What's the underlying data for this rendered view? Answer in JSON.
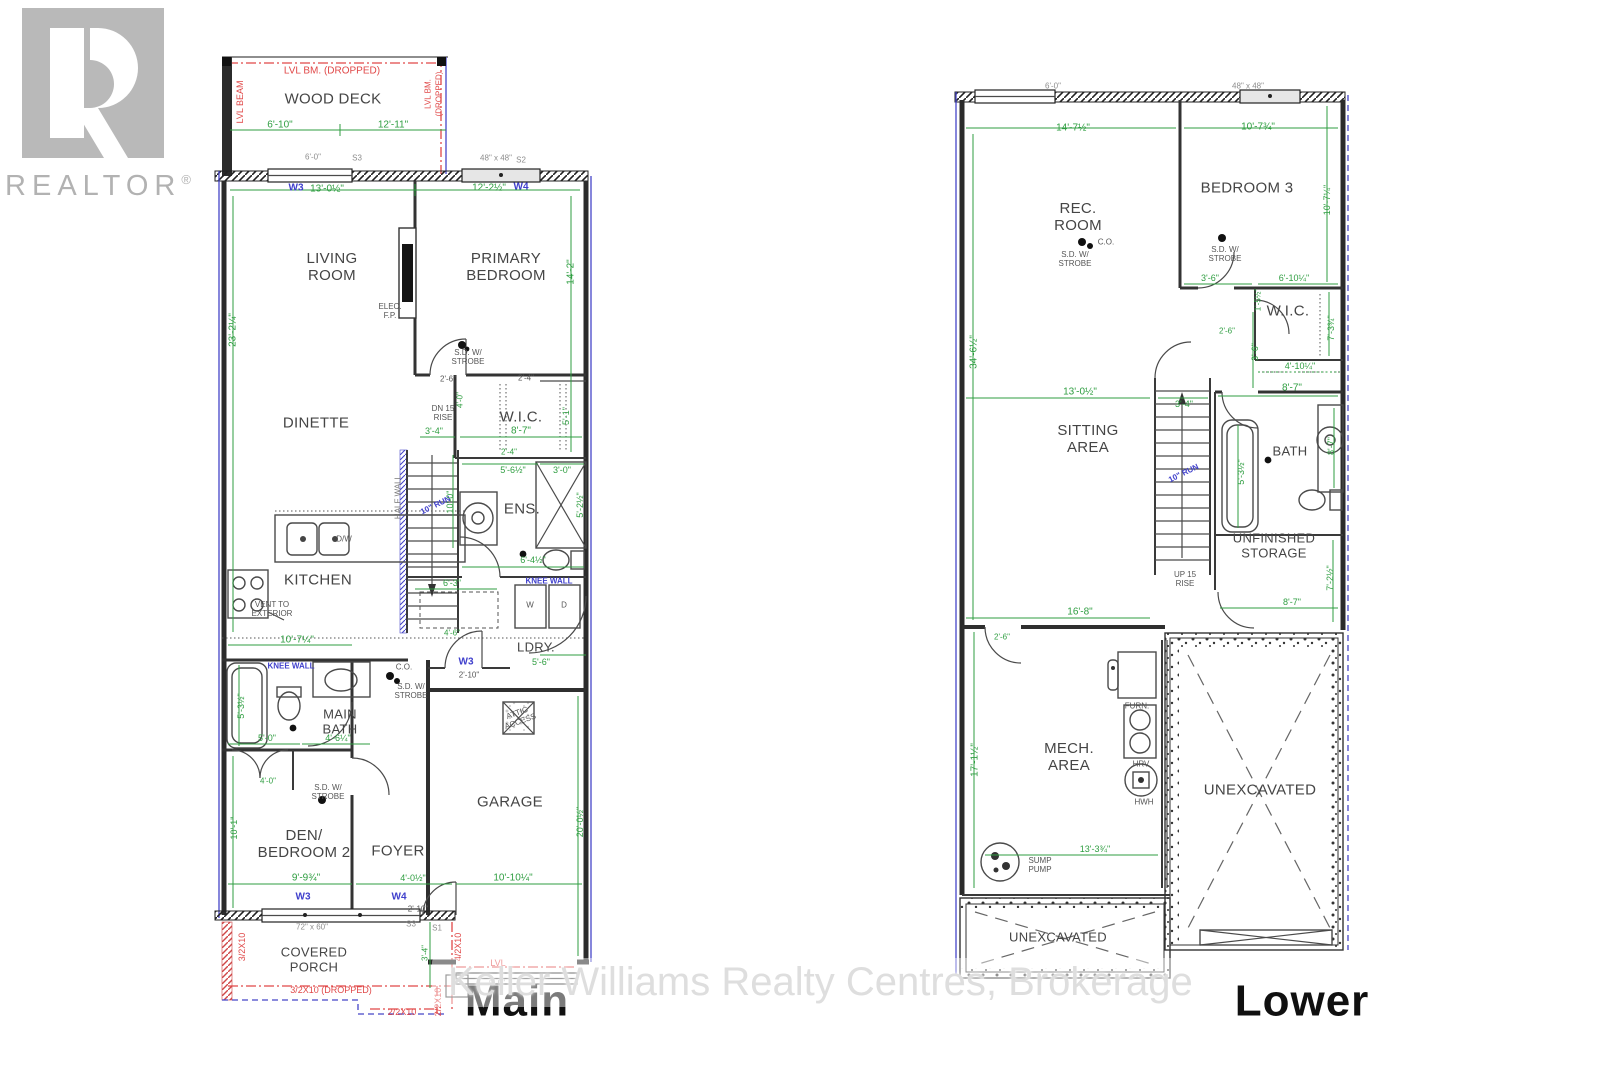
{
  "logo": {
    "letter": "R",
    "brand": "REALTOR",
    "reg": "®"
  },
  "watermark": "Keller Williams Realty Centres, Brokerage",
  "plans": {
    "main": "Main",
    "lower": "Lower"
  },
  "main_floor": {
    "rooms": {
      "wood_deck": "WOOD DECK",
      "living_room": "LIVING\nROOM",
      "primary_bedroom": "PRIMARY\nBEDROOM",
      "dinette": "DINETTE",
      "wic": "W.I.C.",
      "ens": "ENS.",
      "kitchen": "KITCHEN",
      "ldry": "LDRY.",
      "main_bath": "MAIN\nBATH",
      "den_bedroom2": "DEN/\nBEDROOM 2",
      "foyer": "FOYER",
      "garage": "GARAGE",
      "covered_porch": "COVERED\nPORCH"
    },
    "notes": {
      "lvl_bm_dropped": "LVL BM. (DROPPED)",
      "lvl_beam": "LVL BEAM",
      "lvl_bm": "LVL BM.",
      "dropped": "(DROPPED)",
      "elec_fp": "ELEC.\nF.P.",
      "sd_strobe": "S.D. W/\nSTROBE",
      "co": "C.O.",
      "dn15_rise": "DN 15\nRISE",
      "half_wall": "HALF WALL",
      "run10": "10\" RUN",
      "vent_ext": "VENT TO\nEXTERIOR",
      "dw": "D/W",
      "w": "W",
      "d": "D",
      "knee_wall": "KNEE WALL",
      "attic_access": "ATTIC\nACCESS",
      "lvl": "LVL",
      "beam_3_2x10": "3/2X10",
      "beam_4_2x10": "4/2X10",
      "beam_3_2x10_dropped": "3/2X10 (DROPPED)",
      "beam_2_2x10": "2/2X10"
    },
    "windows": {
      "w3": "W3",
      "w4": "W4",
      "s1": "S1",
      "s2": "S2",
      "s3": "S3",
      "size_48": "48\" x 48\"",
      "size_72": "72\" x 60\""
    },
    "dims": {
      "deck_left": "6'-10\"",
      "deck_right": "12'-11\"",
      "deck_win": "6'-0\"",
      "w3_len": "13'-0½\"",
      "w4_len": "12'-2½\"",
      "left_height": "23'-2¼\"",
      "primary_depth": "14'-2\"",
      "d2_4": "2'-4\"",
      "d2_6": "2'-6\"",
      "d2_10": "2'-10\"",
      "d3_0": "3'-0\"",
      "d3_4": "3'-4\"",
      "d4_0": "4'-0\"",
      "d4_0h": "4'-0½\"",
      "d4_6": "4'-6\"",
      "d4_6q": "4'-6¼\"",
      "d5_0": "5'-0\"",
      "d5_1": "5'-1\"",
      "d5_2h": "5'-2½\"",
      "d5_3h": "5'-3½\"",
      "d5_6": "5'-6\"",
      "d5_6h": "5'-6½\"",
      "d6_3": "6'-3\"",
      "d6_4h": "6'-4½\"",
      "d8_7": "8'-7\"",
      "d9_0": "9'-0\"",
      "d9_9": "9'-9¾\"",
      "d10_0": "10'-0\"",
      "d10_1": "10'-1\"",
      "d10_7q": "10'-7¼\"",
      "d10_10": "10'-10¼\"",
      "d20_0h": "20'-0½\""
    }
  },
  "lower_floor": {
    "rooms": {
      "rec_room": "REC.\nROOM",
      "bedroom3": "BEDROOM 3",
      "wic": "W.I.C.",
      "sitting_area": "SITTING\nAREA",
      "bath": "BATH",
      "unfinished_storage": "UNFINISHED\nSTORAGE",
      "mech_area": "MECH.\nAREA",
      "unexcavated": "UNEXCAVATED"
    },
    "notes": {
      "sd_strobe": "S.D. W/\nSTROBE",
      "co": "C.O.",
      "up15_rise": "UP 15\nRISE",
      "run10": "10\" RUN",
      "furn": "FURN.",
      "hrv": "HRV",
      "hwh": "HWH",
      "sump_pump": "SUMP\nPUMP"
    },
    "windows": {
      "size_48": "48\" x 48\"",
      "size_6": "6'-0\""
    },
    "dims": {
      "d14_7h": "14'-7½\"",
      "d10_7t": "10'-7¾\"",
      "d10_7r": "10'-7¼\"",
      "d34_6h": "34'-6½\"",
      "d3_6": "3'-6\"",
      "d6_10q": "6'-10¼\"",
      "d7_3t": "7'-3¾\"",
      "d1_5h": "1'-5½\"",
      "d2_6": "2'-6\"",
      "d4_10q": "4'-10¼\"",
      "d13_0h": "13'-0½\"",
      "d3_4": "3'-4\"",
      "d8_7": "8'-7\"",
      "d5_3h": "5'-3½\"",
      "d7_2h": "7'-2½\"",
      "d16_8": "16'-8\"",
      "d17_1h": "17'-1½\"",
      "d13_3t": "13'-3¾\""
    }
  }
}
